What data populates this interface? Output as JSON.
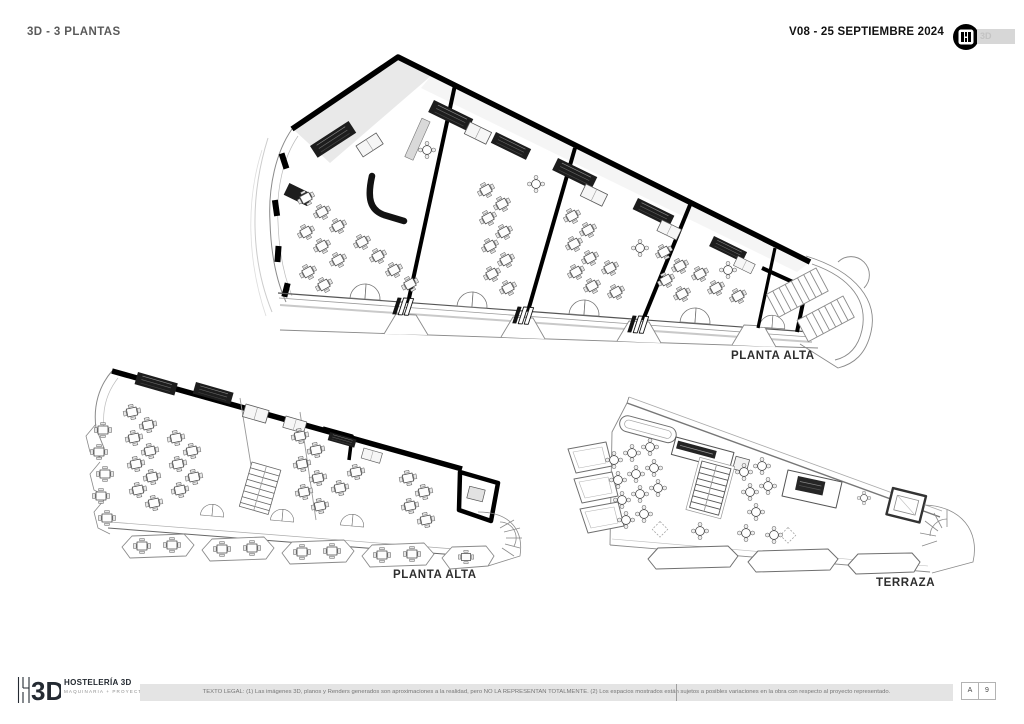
{
  "page": {
    "title": "3D - 3 PLANTAS",
    "version_date": "V08 - 25 SEPTIEMBRE 2024",
    "header_logo_tag": "3D"
  },
  "plans": [
    {
      "id": "planta-alta-upper",
      "label": "PLANTA ALTA"
    },
    {
      "id": "planta-alta-lower",
      "label": "PLANTA ALTA"
    },
    {
      "id": "terraza",
      "label": "TERRAZA"
    }
  ],
  "footer": {
    "brand": {
      "name": "HOSTELERÍA 3D",
      "tagline": "MAQUINARIA + PROYECTOS",
      "monogram": "3D"
    },
    "legal": "TEXTO LEGAL:  (1) Las imágenes 3D, planos y Renders generados  son aproximaciones a la realidad, pero NO LA REPRESENTAN TOTALMENTE. (2) Los espacios mostrados están sujetos a posibles variaciones en la obra con respecto al proyecto representado.",
    "sheet_series": "A",
    "sheet_number": "9"
  }
}
